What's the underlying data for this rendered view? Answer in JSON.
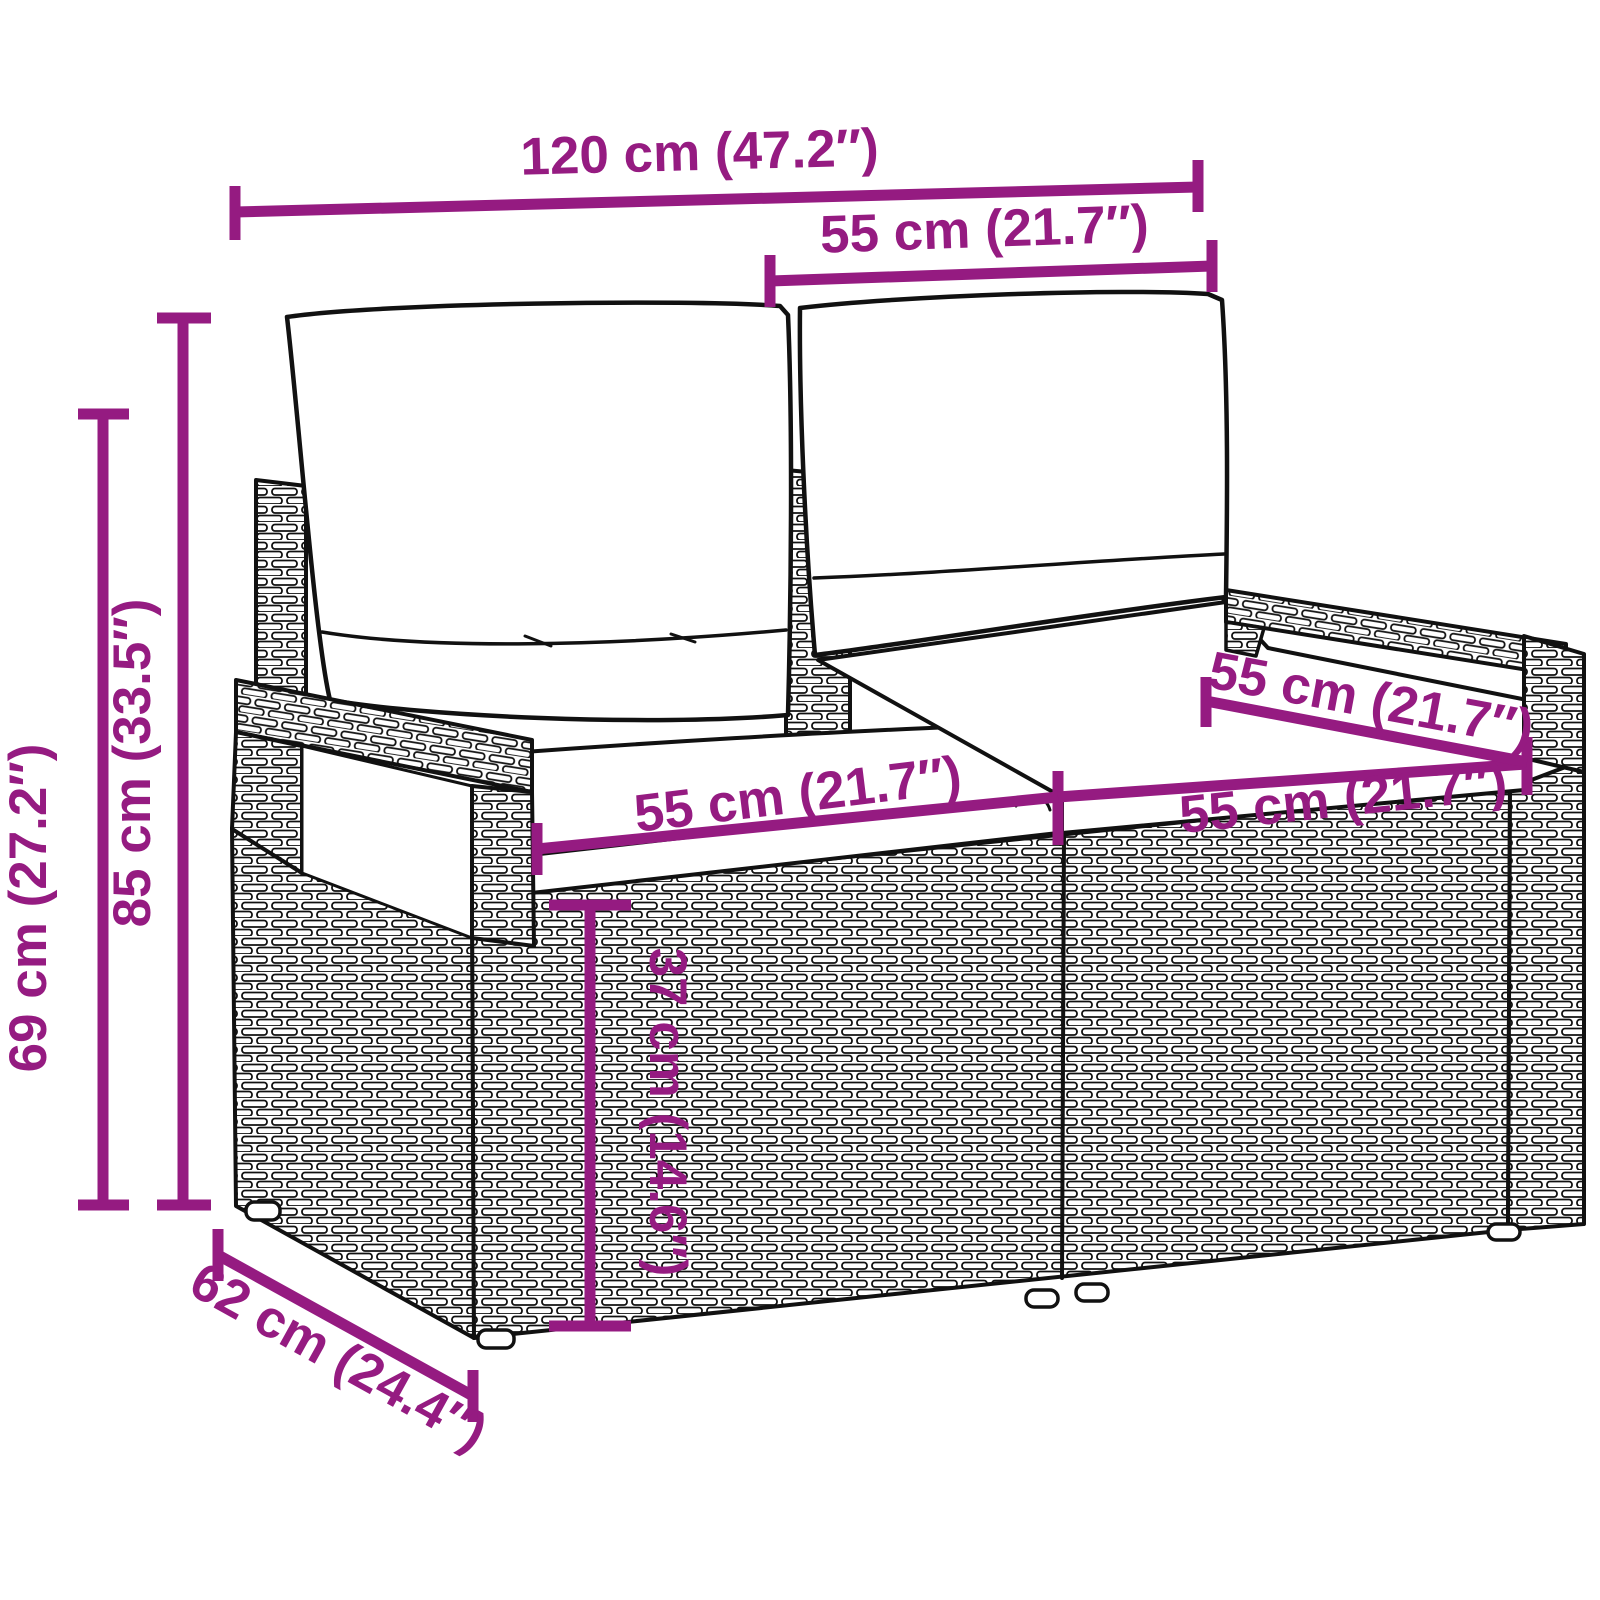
{
  "diagram": {
    "kind": "furniture-dimension-diagram",
    "product": "poly rattan 2-seater garden sofa with back and seat cushions",
    "colors": {
      "dimension_accent": "#951b81",
      "line_art": "#111111",
      "background": "#ffffff"
    },
    "dimensions": {
      "overall_width": {
        "label": "120 cm (47.2″)"
      },
      "back_section_width": {
        "label": "55 cm (21.7″)"
      },
      "overall_height": {
        "label": "85 cm (33.5″)"
      },
      "frame_height": {
        "label": "69 cm (27.2″)"
      },
      "seat_width_left": {
        "label": "55 cm (21.7″)"
      },
      "seat_width_right": {
        "label": "55 cm (21.7″)"
      },
      "seat_depth": {
        "label": "55 cm (21.7″)"
      },
      "seat_height": {
        "label": "37 cm (14.6″)"
      },
      "overall_depth": {
        "label": "62 cm (24.4″)"
      }
    }
  }
}
